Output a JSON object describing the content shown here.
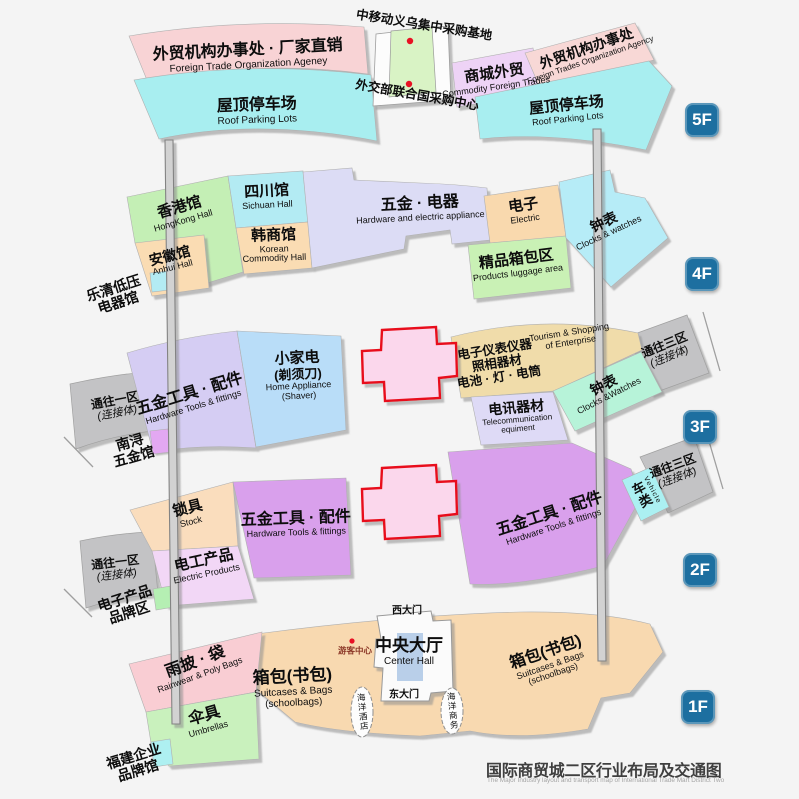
{
  "title": {
    "zh": "国际商贸城二区行业布局及交通图",
    "en": "The Major Industry layout and transport map of International Trade Mart District Two"
  },
  "floor_badges": {
    "f5": "5F",
    "f4": "4F",
    "f3": "3F",
    "f2": "2F",
    "f1": "1F"
  },
  "colors": {
    "badge_blue": "#1d6fa0",
    "red_marker": "#e81123",
    "cross_border_red": "#e8111a",
    "connector_gray": "#c3c3c5",
    "caption_gray": "#3f3f3f",
    "hall_blue": "#b9cfe9"
  },
  "f5": {
    "ftoa_left": {
      "zh": "外贸机构办事处 · 厂家直销",
      "en": "Foreign Trade Organization Ageney"
    },
    "roof_left": {
      "zh": "屋顶停车场",
      "en": "Roof Parking Lots"
    },
    "cmcc_base": {
      "zh": "中移动义乌集中采购基地"
    },
    "mofa_center": {
      "zh": "外交部联合国采购中心"
    },
    "mall_foreign": {
      "zh": "商城外贸",
      "en": "Commodity Foreign Trades"
    },
    "ftoa_right": {
      "zh": "外贸机构办事处",
      "en": "Foreign Trades Organization Agency"
    },
    "roof_right": {
      "zh": "屋顶停车场",
      "en": "Roof Parking Lots"
    }
  },
  "f4": {
    "hongkong": {
      "zh": "香港馆",
      "en": "HongKong Hall"
    },
    "sichuan": {
      "zh": "四川馆",
      "en": "Sichuan Hall"
    },
    "anhui": {
      "zh": "安徽馆",
      "en": "Anhui Hall"
    },
    "korean": {
      "zh": "韩商馆",
      "en1": "Korean",
      "en2": "Commodity Hall"
    },
    "hardware_electric": {
      "zh": "五金 · 电器",
      "en": "Hardware and electric appliance"
    },
    "electric": {
      "zh": "电子",
      "en": "Electric"
    },
    "luggage": {
      "zh": "精品箱包区",
      "en": "Products luggage area"
    },
    "clocks": {
      "zh": "钟表",
      "en": "Clocks & watches"
    },
    "yueqing": {
      "zh1": "乐清低压",
      "zh2": "电器馆"
    }
  },
  "f3": {
    "hardware_tools": {
      "zh": "五金工具 · 配件",
      "en": "Hardware Tools & fittings"
    },
    "home_appliance": {
      "zh1": "小家电",
      "zh2": "(剃须刀)",
      "en1": "Home Appliance",
      "en2": "(Shaver)"
    },
    "instruments": {
      "zh1": "电子仪表仪器",
      "zh2": "照相器材",
      "zh3": "电池 · 灯 · 电筒"
    },
    "tourism": {
      "en1": "Tourism & Shopping",
      "en2": "of Enterprise"
    },
    "telecom": {
      "zh": "电讯器材",
      "en1": "Telecommunication",
      "en2": "equiment"
    },
    "clocks": {
      "zh": "钟表",
      "en": "Clocks &Watches"
    },
    "conn_west": {
      "zh1": "通往一区",
      "zh2": "(连接体)"
    },
    "conn_east": {
      "zh1": "通往三区",
      "zh2": "(连接体)"
    },
    "nanxun": {
      "zh1": "南浔",
      "zh2": "五金馆"
    }
  },
  "f2": {
    "lock": {
      "zh": "锁具",
      "en": "Stock"
    },
    "electric_products": {
      "zh": "电工产品",
      "en": "Electric Products"
    },
    "hardware_tools": {
      "zh": "五金工具 · 配件",
      "en": "Hardware Tools & fittings"
    },
    "vehicle": {
      "zh": "车类",
      "en": "Vehicle"
    },
    "conn_west": {
      "zh1": "通往一区",
      "zh2": "(连接体)"
    },
    "conn_east": {
      "zh1": "通往三区",
      "zh2": "(连接体)"
    },
    "ebrand": {
      "zh1": "电子产品",
      "zh2": "品牌区"
    }
  },
  "f1": {
    "rainwear": {
      "zh": "雨披 · 袋",
      "en": "Rainwear & Poly Bags"
    },
    "umbrella": {
      "zh": "伞具",
      "en": "Umbrellas"
    },
    "bags": {
      "zh": "箱包(书包)",
      "en1": "Suitcases & Bags",
      "en2": "(schoolbags)"
    },
    "visitor_center": {
      "zh": "游客中心"
    },
    "center_hall": {
      "zh": "中央大厅",
      "en": "Center Hall"
    },
    "west_gate": {
      "zh": "西大门"
    },
    "east_gate": {
      "zh": "东大门"
    },
    "ocean_hotel": {
      "zh": "海洋酒店"
    },
    "ocean_business": {
      "zh": "海洋商务"
    },
    "fujian": {
      "zh1": "福建企业",
      "zh2": "品牌馆"
    }
  }
}
